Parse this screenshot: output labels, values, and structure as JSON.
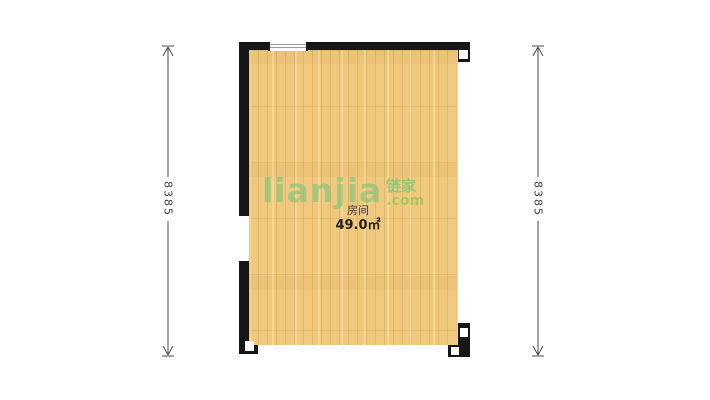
{
  "floorplan": {
    "room": {
      "label": "房间",
      "area": "49.0㎡"
    },
    "dimensions": {
      "left": "8385",
      "right": "8385"
    },
    "watermark": {
      "brand": "lianjia",
      "cn": "链家",
      "domain": ".com"
    },
    "colors": {
      "wall": "#161616",
      "floor": "#f0c97e",
      "watermark_green": "#7ac47a",
      "dimension_line": "#4a4a4a"
    }
  }
}
